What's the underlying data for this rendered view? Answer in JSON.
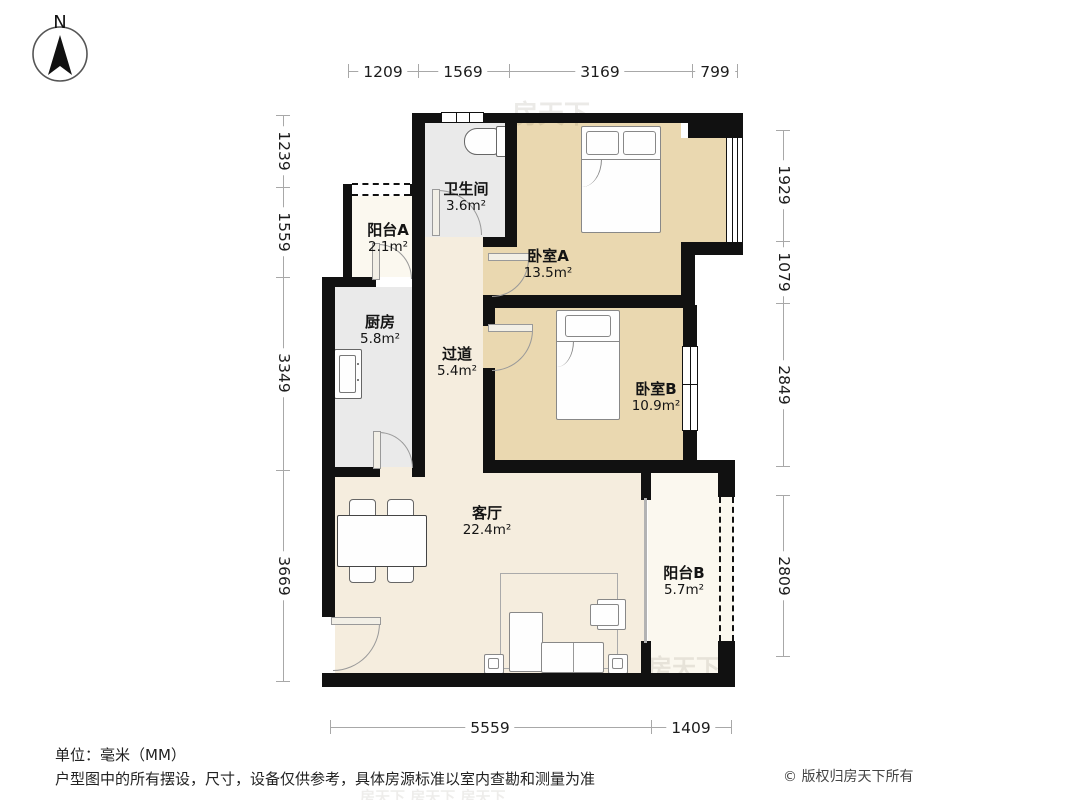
{
  "compass": {
    "label": "N"
  },
  "rooms": {
    "bathroom": {
      "name": "卫生间",
      "area": "3.6m²"
    },
    "balcony_a": {
      "name": "阳台A",
      "area": "2.1m²"
    },
    "bedroom_a": {
      "name": "卧室A",
      "area": "13.5m²"
    },
    "kitchen": {
      "name": "厨房",
      "area": "5.8m²"
    },
    "corridor": {
      "name": "过道",
      "area": "5.4m²"
    },
    "bedroom_b": {
      "name": "卧室B",
      "area": "10.9m²"
    },
    "living": {
      "name": "客厅",
      "area": "22.4m²"
    },
    "balcony_b": {
      "name": "阳台B",
      "area": "5.7m²"
    }
  },
  "dimensions": {
    "top": [
      "1209",
      "1569",
      "3169",
      "799"
    ],
    "left": [
      "1239",
      "1559",
      "3349",
      "3669"
    ],
    "right": [
      "1929",
      "1079",
      "2849",
      "2809"
    ],
    "bottom": [
      "5559",
      "1409"
    ]
  },
  "footer": {
    "unit_note": "单位：毫米（MM）",
    "disclaimer": "户型图中的所有摆设，尺寸，设备仅供参考，具体房源标准以室内查勘和测量为准",
    "copyright": "© 版权归房天下所有"
  },
  "watermark": {
    "text": "房天下",
    "row": "房天下  房天下  房天下"
  },
  "colors": {
    "wall": "#111111",
    "bedroom_fill": "#ead8b0",
    "living_fill": "#f5edde",
    "balcony_fill": "#fbf8ef",
    "service_fill": "#eaeaea",
    "dimension_line": "#a8a8a8",
    "door_arc": "#999999"
  }
}
